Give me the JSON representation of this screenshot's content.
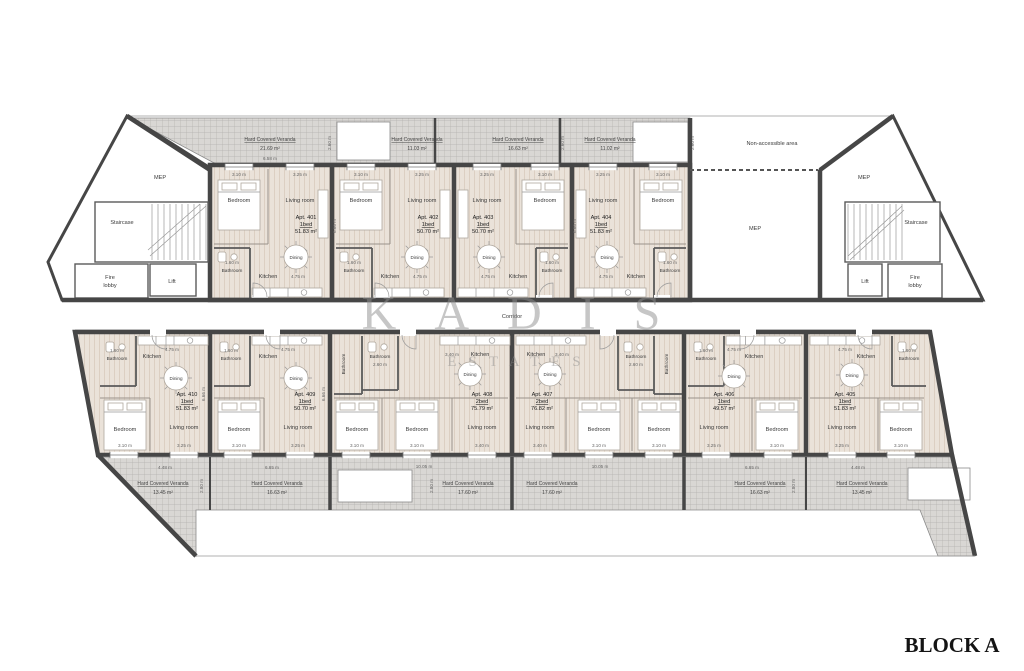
{
  "title": "BLOCK A",
  "watermark": {
    "name": "KADIS",
    "sub": "ESTATES"
  },
  "labels": {
    "corridor": "Corridor",
    "non_accessible": "Non-accessible area",
    "mep": "MEP",
    "staircase": "Staircase",
    "fire1": "Fire",
    "fire2": "lobby",
    "lift": "Lift",
    "veranda": "Hard Covered Veranda"
  },
  "rooms": {
    "bedroom": "Bedroom",
    "living": "Living room",
    "dining": "Dining",
    "kitchen": "Kitchen",
    "bathroom": "Bathroom"
  },
  "dims": {
    "bed": "3.10 m",
    "living": "3.25 m",
    "kitchen": "4.75 m",
    "bath": "1.60 m",
    "kitchen2": "3.40 m",
    "living2": "3.40 m",
    "d26": "2.60 m",
    "d28": "2.80 m",
    "h666": "6.66 m",
    "v_top": "6.58 m",
    "v448": "4.48 m",
    "v665": "6.65 m",
    "v1005": "10.05 m"
  },
  "apartments_top": [
    {
      "id": "Apt. 401",
      "type": "1bed",
      "area": "51.83 m²"
    },
    {
      "id": "Apt. 402",
      "type": "1bed",
      "area": "50.70 m²"
    },
    {
      "id": "Apt. 403",
      "type": "1bed",
      "area": "50.70 m²"
    },
    {
      "id": "Apt. 404",
      "type": "1bed",
      "area": "51.83 m²"
    }
  ],
  "apartments_bottom": [
    {
      "id": "Apt. 410",
      "type": "1bed",
      "area": "51.83 m²"
    },
    {
      "id": "Apt. 409",
      "type": "1bed",
      "area": "50.70 m²"
    },
    {
      "id": "Apt. 408",
      "type": "2bed",
      "area": "75.79 m²"
    },
    {
      "id": "Apt. 407",
      "type": "2bed",
      "area": "76.82 m²"
    },
    {
      "id": "Apt. 406",
      "type": "1bed",
      "area": "49.57 m²"
    },
    {
      "id": "Apt. 405",
      "type": "1bed",
      "area": "51.83 m²"
    }
  ],
  "verandas_top": [
    {
      "area": "21.69 m²"
    },
    {
      "area": "11.03 m²"
    },
    {
      "area": "16.63 m²"
    },
    {
      "area": "11.02 m²"
    }
  ],
  "verandas_bottom": [
    {
      "area": "13.45 m²"
    },
    {
      "area": "16.63 m²"
    },
    {
      "area": "17.60 m²"
    },
    {
      "area": "17.60 m²"
    },
    {
      "area": "16.63 m²"
    },
    {
      "area": "13.45 m²"
    }
  ]
}
